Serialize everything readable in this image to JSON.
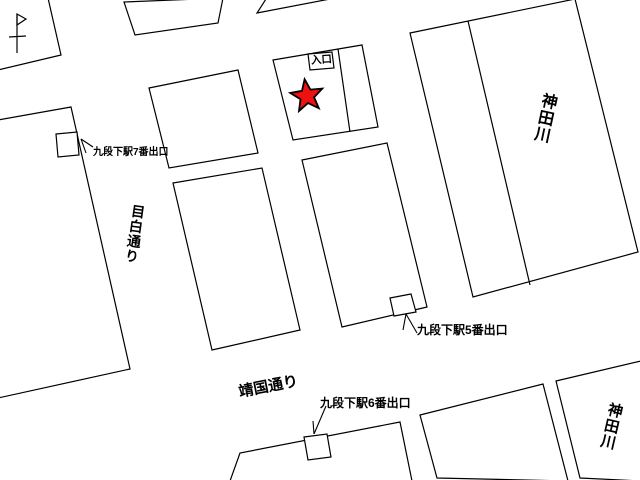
{
  "map": {
    "background_color": "#ffffff",
    "line_color": "#000000",
    "labels": {
      "entrance": "入口",
      "exit7": "九段下駅7番出口",
      "exit5": "九段下駅5番出口",
      "exit6": "九段下駅6番出口",
      "street_mejiro": "目白通り",
      "street_yasukuni": "靖国通り",
      "river_top": "神田川",
      "river_bottom": "神田川"
    },
    "marker": {
      "type": "star",
      "color": "#ee1111",
      "meaning": "destination"
    },
    "symbols": {
      "flag": "north-flag"
    }
  }
}
